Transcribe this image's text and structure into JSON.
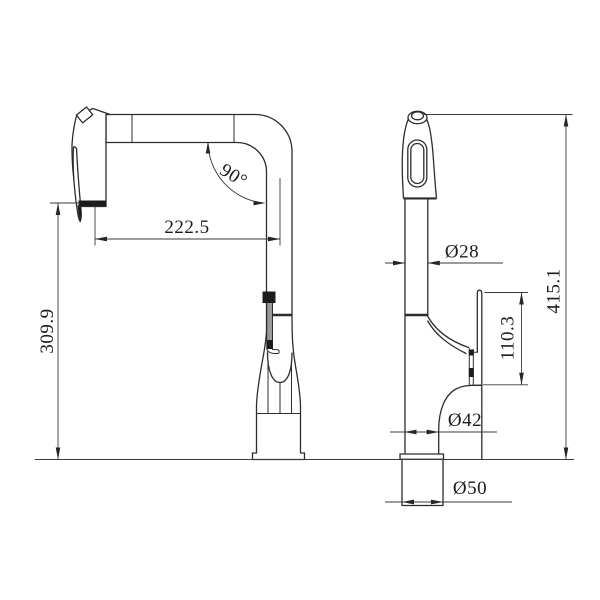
{
  "drawing": {
    "description": "Technical dimension drawing of a pull-out kitchen faucet, two orthographic views",
    "background_color": "#ffffff",
    "line_color": "#2d2d2d",
    "dim_color": "#3a3a3a",
    "views": {
      "side_view_name": "faucet-side-view",
      "front_view_name": "faucet-front-view"
    },
    "dimensions": {
      "spout_reach": "222.5",
      "spout_angle": "90°",
      "spout_height": "309.9",
      "spray_pipe_diameter": "Ø28",
      "overall_height": "415.1",
      "handle_height": "110.3",
      "body_diameter": "Ø42",
      "base_diameter": "Ø50"
    }
  }
}
